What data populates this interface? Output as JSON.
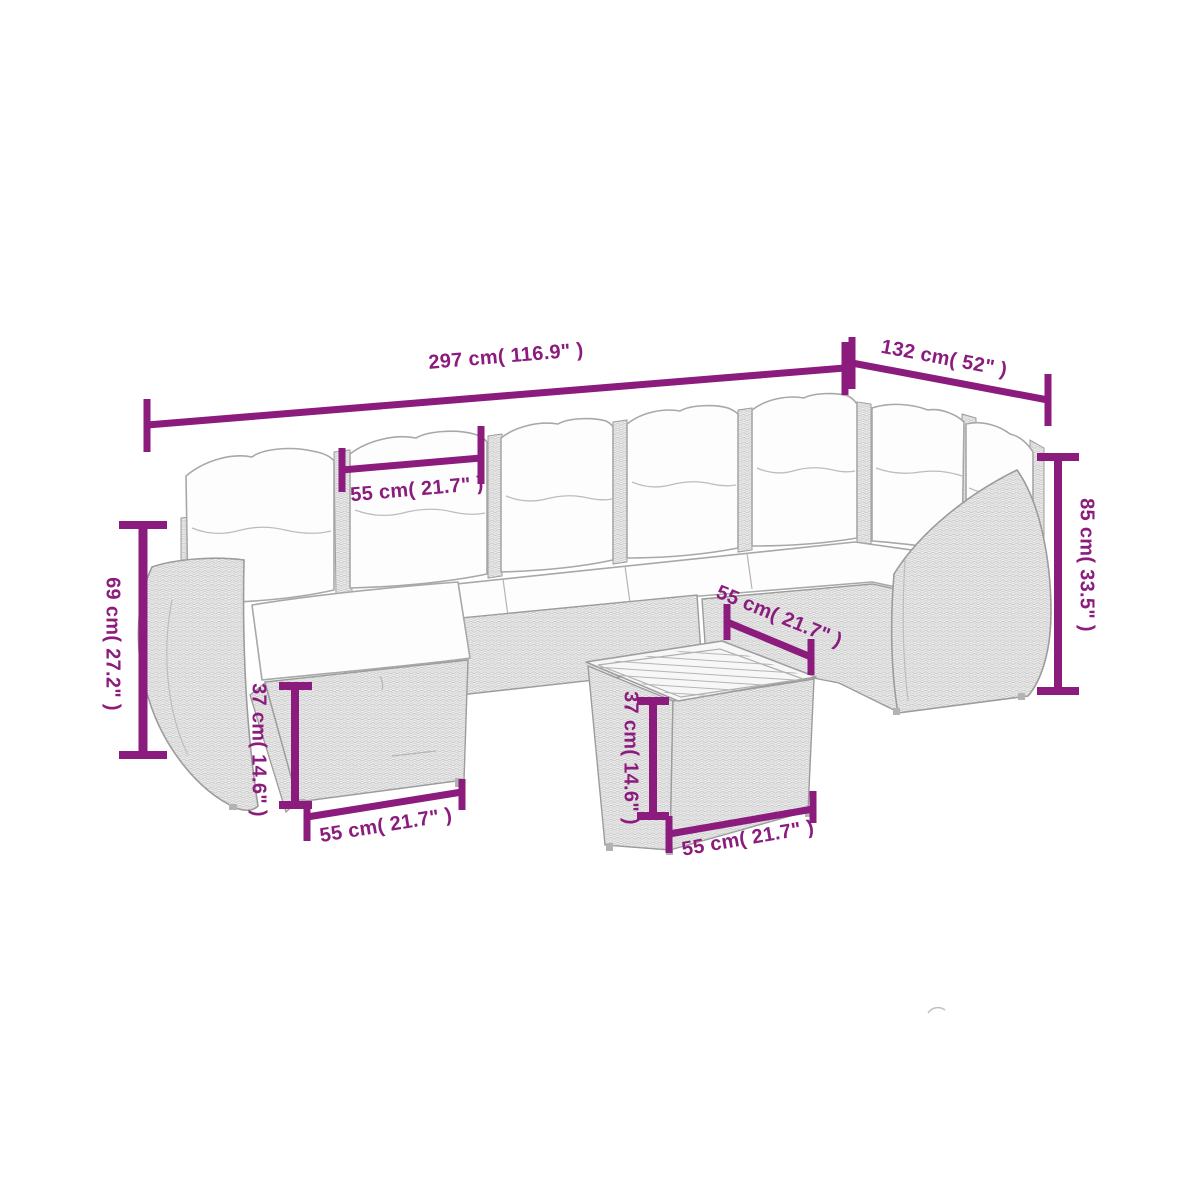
{
  "image": {
    "title": "Garden lounge set dimension diagram",
    "background_color": "#ffffff",
    "accent_color": "#8b1b7d",
    "line_art_color": "#9e9e9e"
  },
  "dimensions": {
    "total_width": "297 cm( 116.9\" )",
    "total_depth": "132 cm( 52\" )",
    "arm_height_left": "69 cm( 27.2\" )",
    "back_height_right": "85 cm( 33.5\" )",
    "cushion_width": "55 cm( 21.7\" )",
    "seat_depth": "55 cm( 21.7\" )",
    "ottoman_height": "37 cm( 14.6\" )",
    "ottoman_width": "55 cm( 21.7\" )",
    "table_height": "37 cm( 14.6\" )",
    "table_width": "55 cm( 21.7\" )"
  }
}
